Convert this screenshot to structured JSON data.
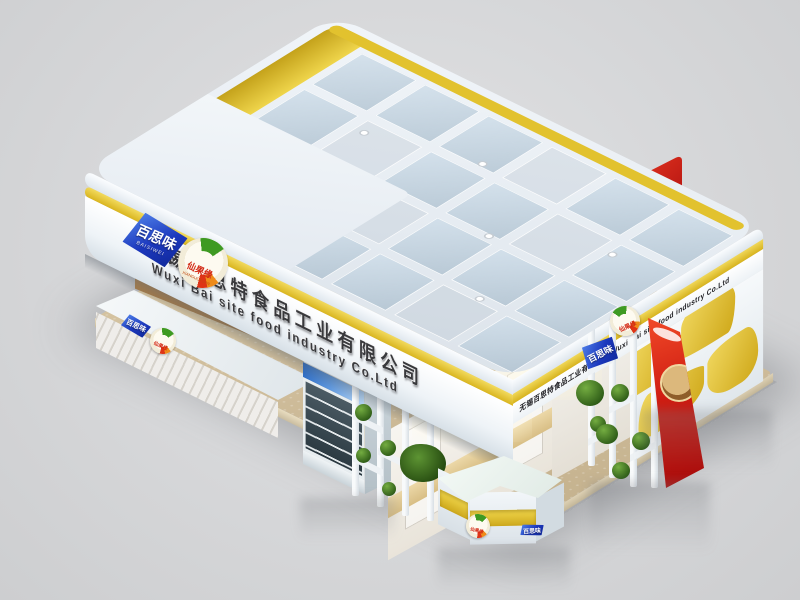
{
  "scene": {
    "description": "3D render of a food-industry exhibition booth",
    "background_color": "#d6d7d9",
    "floor_color": "#cfbd9b",
    "accent_yellow": "#e3c331",
    "structure_white": "#eef2f6",
    "glass_tint": "rgba(170,192,208,0.55)"
  },
  "fascia": {
    "company_cn": "无锡百思特食品工业有限公司",
    "company_en": "Wuxi Bai site food industry Co.Ltd",
    "side_text": "无锡百思特食品工业有限公司  Wuxi Bai site food industry Co.Ltd"
  },
  "logos": {
    "blue": {
      "text": "百思味",
      "subtext": "BAISIWEI",
      "color": "#1c38bd"
    },
    "fruit": {
      "text": "仙果缘",
      "subtext": "XIANGUOYUAN",
      "green": "#3e9a22",
      "orange": "#ef8b1a",
      "red": "#d22814"
    }
  }
}
